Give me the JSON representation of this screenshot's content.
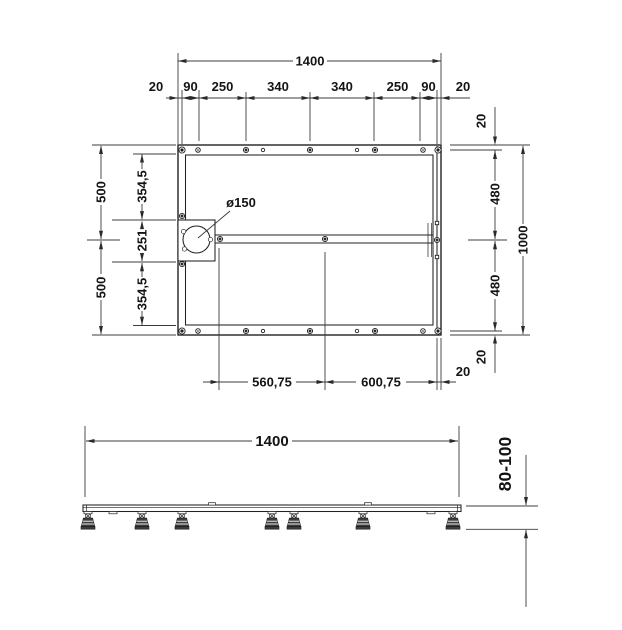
{
  "plan": {
    "width_total": "1400",
    "segments": [
      "20",
      "90",
      "250",
      "340",
      "340",
      "250",
      "90",
      "20"
    ],
    "halves_left": [
      "500",
      "500"
    ],
    "inner_left": [
      "354,5",
      "251",
      "354,5"
    ],
    "right": [
      "20",
      "480",
      "480",
      "20"
    ],
    "height_total": "1000",
    "drain": "ø150",
    "bottom_chain": [
      "560,75",
      "600,75",
      "20"
    ]
  },
  "elevation": {
    "width": "1400",
    "height": "80-100"
  }
}
